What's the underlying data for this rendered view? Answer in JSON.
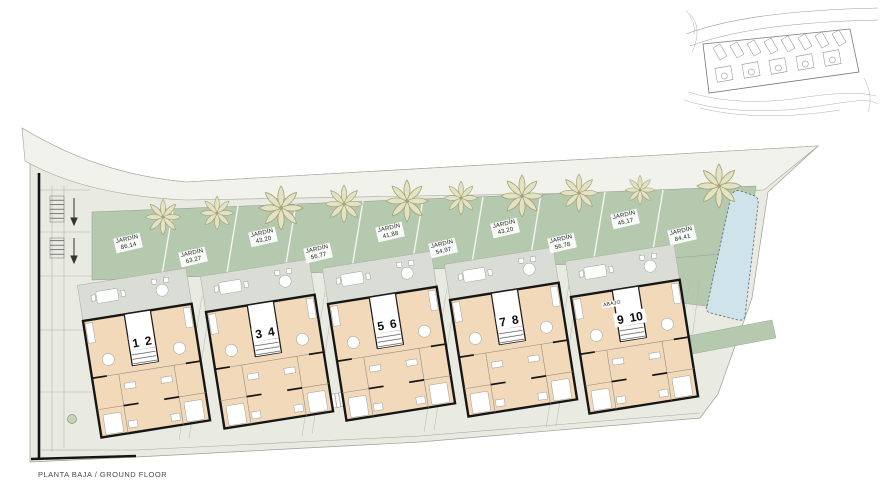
{
  "plan": {
    "floor_label": "PLANTA BAJA / GROUND FLOOR",
    "abajo_label": "ABAJO"
  },
  "gardens": [
    {
      "label": "JARDÍN",
      "area": "86,14"
    },
    {
      "label": "JARDÍN",
      "area": "63,27"
    },
    {
      "label": "JARDÍN",
      "area": "43,20"
    },
    {
      "label": "JARDÍN",
      "area": "56,77"
    },
    {
      "label": "JARDÍN",
      "area": "41,88"
    },
    {
      "label": "JARDÍN",
      "area": "54,97"
    },
    {
      "label": "JARDÍN",
      "area": "43,20"
    },
    {
      "label": "JARDÍN",
      "area": "56,78"
    },
    {
      "label": "JARDÍN",
      "area": "45,17"
    },
    {
      "label": "JARDÍN",
      "area": "84,41"
    }
  ],
  "units": [
    "1",
    "2",
    "3",
    "4",
    "5",
    "6",
    "7",
    "8",
    "9",
    "10"
  ],
  "colors": {
    "garden_green": "#b5c9af",
    "pool_blue": "#cfe3ea",
    "interior_beige": "#f2d9ba",
    "terrace_gray": "#daddd5",
    "paving": "#e9ebe2",
    "road_band": "#f1f2ec",
    "wall_black": "#161616",
    "tree_olive": "#e3e2c4"
  }
}
